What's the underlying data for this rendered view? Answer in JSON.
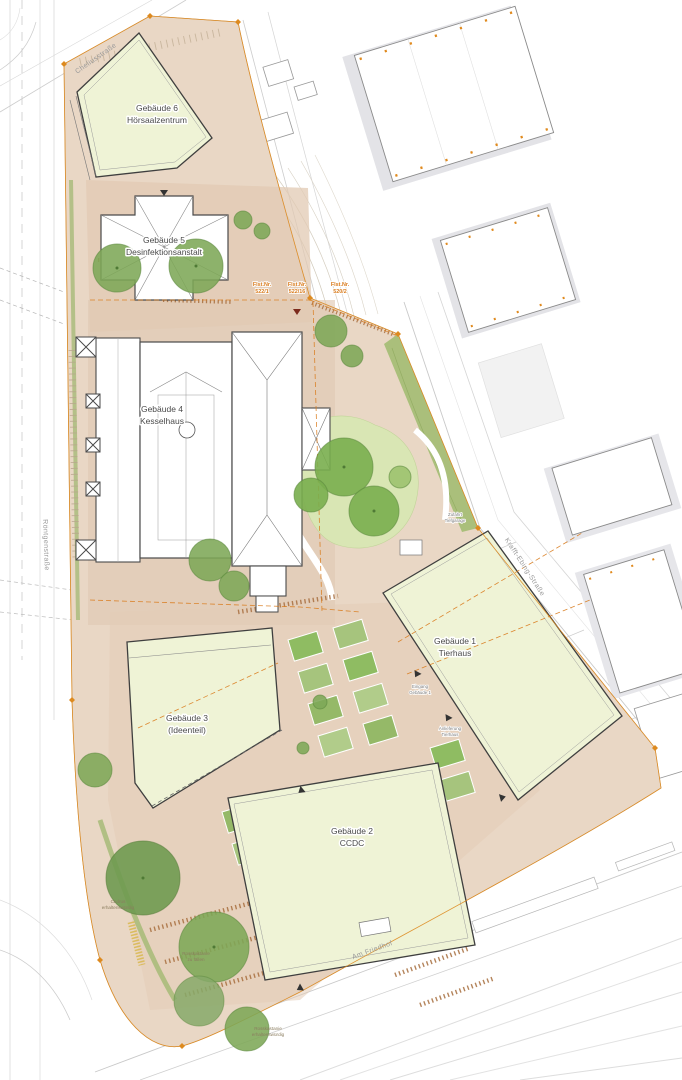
{
  "plan": {
    "buildings": [
      {
        "id": "gebaeude-6",
        "line1": "Gebäude 6",
        "line2": "Hörsaalzentrum"
      },
      {
        "id": "gebaeude-5",
        "line1": "Gebäude 5",
        "line2": "Desinfektionsanstalt"
      },
      {
        "id": "gebaeude-4",
        "line1": "Gebäude 4",
        "line2": "Kesselhaus"
      },
      {
        "id": "gebaeude-1",
        "line1": "Gebäude 1",
        "line2": "Tierhaus"
      },
      {
        "id": "gebaeude-3",
        "line1": "Gebäude 3",
        "line2": "(Ideenteil)"
      },
      {
        "id": "gebaeude-2",
        "line1": "Gebäude 2",
        "line2": "CCDC"
      }
    ],
    "streets": {
      "top_left": "Cheliusstraße",
      "left": "Röntgenstraße",
      "right": "Krafft-Ebing-Straße",
      "bottom": "Am Friedhof"
    },
    "parcels": [
      {
        "line1": "Flst.Nr.",
        "line2": "522/1"
      },
      {
        "line1": "Flst.Nr.",
        "line2": "522/16"
      },
      {
        "line1": "Flst.Nr.",
        "line2": "520/2"
      }
    ],
    "tree_notes": [
      {
        "line1": "Cedrus",
        "line2": "erhaltenswürdig"
      },
      {
        "line1": "Rosskastanie",
        "line2": "zu fällen"
      },
      {
        "line1": "Rosskastanie",
        "line2": "erhaltenswürdig"
      }
    ],
    "annotations": [
      {
        "line1": "Zufahrt",
        "line2": "Tiefgarage"
      },
      {
        "line1": "Eingang",
        "line2": "Gebäude 1"
      },
      {
        "line1": "Anlieferung",
        "line2": "Tierhaus"
      }
    ],
    "colors": {
      "ground": "#e9d7c5",
      "plaza": "#e1c9b3",
      "building_new": "#eff3d6",
      "building_existing": "#ffffff",
      "tree": "#7da757",
      "lawn": "#d9e6b4",
      "hedge": "#9db76d",
      "boundary_orange": "#dd8a1f",
      "outline": "#3f3f3f"
    }
  }
}
